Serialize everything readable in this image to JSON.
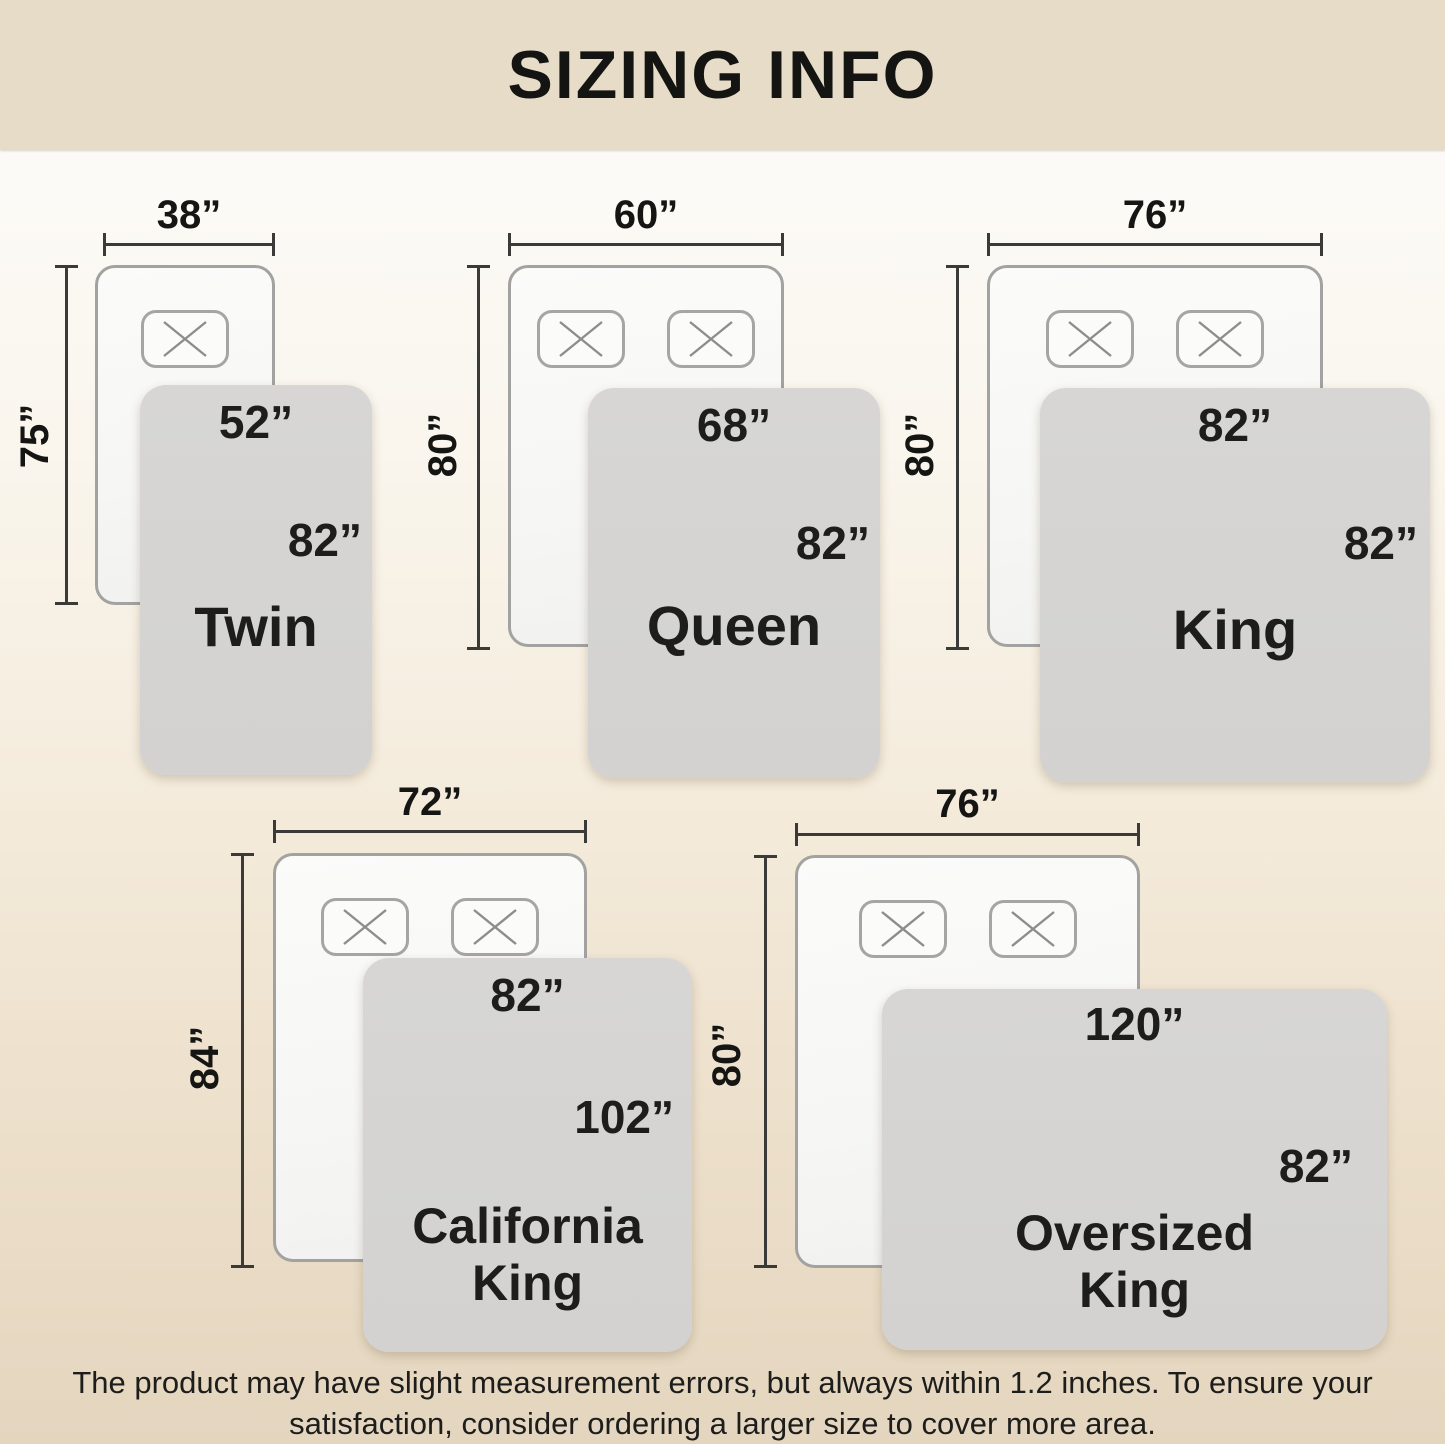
{
  "title": "SIZING INFO",
  "diagrams": {
    "twin": {
      "name": "Twin",
      "mattress_width": "38”",
      "mattress_length": "75”",
      "blanket_width": "52”",
      "blanket_length": "82”"
    },
    "queen": {
      "name": "Queen",
      "mattress_width": "60”",
      "mattress_length": "80”",
      "blanket_width": "68”",
      "blanket_length": "82”"
    },
    "king": {
      "name": "King",
      "mattress_width": "76”",
      "mattress_length": "80”",
      "blanket_width": "82”",
      "blanket_length": "82”"
    },
    "california_king": {
      "name": "California King",
      "mattress_width": "72”",
      "mattress_length": "84”",
      "blanket_width": "82”",
      "blanket_length": "102”"
    },
    "oversized_king": {
      "name": "Oversized King",
      "mattress_width": "76”",
      "mattress_length": "80”",
      "blanket_width": "120”",
      "blanket_length": "82”"
    }
  },
  "footer": {
    "line1": "The product may have slight measurement errors, but always within 1.2 inches. To ensure your",
    "line2": "satisfaction, consider ordering a larger size to cover more area."
  },
  "colors": {
    "header_bg": "#e7dcc7",
    "page_gradient_bottom": "#e4d5bf",
    "blanket_fill": "#d5d4d2",
    "mattress_border": "#a2a2a0",
    "dimension_line": "#3a3a38",
    "text": "#1c1c1a"
  },
  "icons": {
    "pillow_marker": "x-icon"
  }
}
